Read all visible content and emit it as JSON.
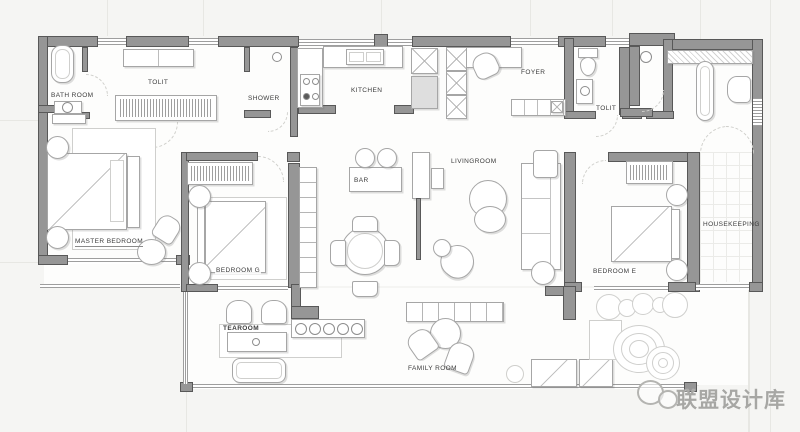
{
  "rooms": {
    "bathroom": {
      "label": "BATH ROOM"
    },
    "tolit_left": {
      "label": "TOLIT"
    },
    "shower": {
      "label": "SHOWER"
    },
    "kitchen": {
      "label": "KITCHEN"
    },
    "foyer": {
      "label": "FOYER"
    },
    "tolit_right": {
      "label": "TOLIT"
    },
    "master_bedroom": {
      "label": "MASTER BEDROOM"
    },
    "bedroom_g": {
      "label": "BEDROOM G"
    },
    "bar": {
      "label": "BAR"
    },
    "livingroom": {
      "label": "LIVINGROOM"
    },
    "bedroom_e": {
      "label": "BEDROOM E"
    },
    "housekeeping": {
      "label": "HOUSEKEEPING"
    },
    "tearoom": {
      "label": "TEAROOM"
    },
    "family_room": {
      "label": "FAMILY ROOM"
    }
  },
  "watermark": {
    "text": "联盟设计库",
    "icon": "wechat-logo-icon"
  },
  "colors": {
    "wall": "#969696",
    "wall_outline": "#585858",
    "background": "#f5f5f3",
    "room_fill": "#fdfdfc",
    "furniture_line": "#a6a6a6",
    "label_text": "#3b3b3b",
    "watermark_gray": "#a7a7a4"
  }
}
